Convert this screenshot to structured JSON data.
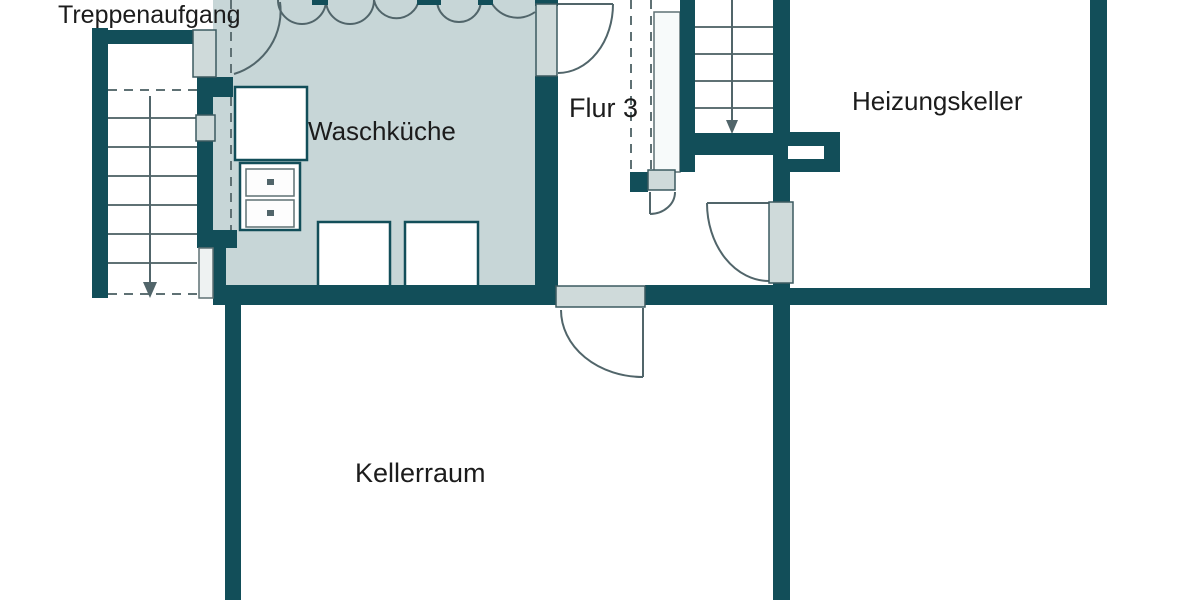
{
  "rooms": {
    "treppenaufgang": {
      "label": "Treppenaufgang"
    },
    "waschkueche": {
      "label": "Waschküche"
    },
    "flur": {
      "label": "Flur 3"
    },
    "heizungskeller": {
      "label": "Heizungskeller"
    },
    "kellerraum": {
      "label": "Kellerraum"
    }
  },
  "colors": {
    "wall": "#124e59",
    "room_fill": "#c7d6d7",
    "door_panel": "#cfdada",
    "outline": "#3c5a60",
    "arc": "#51656a",
    "stair_line": "#5f7174",
    "background": "#ffffff",
    "text": "#1c1c1c"
  }
}
